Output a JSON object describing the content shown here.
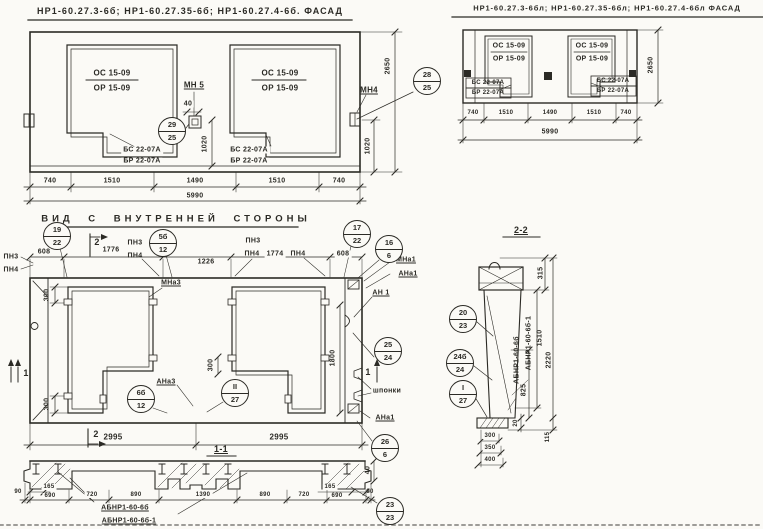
{
  "ink": "#2b2a25",
  "paper": "#fbfaf6",
  "facade_main": {
    "title": "НР1-60.27.3-6б; НР1-60.27.35-6б; НР1-60.27.4-6б. ФАСАД",
    "win1_line1": "ОС 15-09",
    "win1_line2": "ОР 15-09",
    "win2_line1": "ОС 15-09",
    "win2_line2": "ОР 15-09",
    "win1_sill1": "БС 22-07А",
    "win1_sill2": "БР 22-07А",
    "win2_sill1": "БС 22-07А",
    "win2_sill2": "БР 22-07А",
    "label_mn5": "МН 5",
    "label_mn4": "МН4",
    "dim_40": "40",
    "balloon_29_top": "29",
    "balloon_29_bot": "25",
    "balloon_28_top": "28",
    "balloon_28_bot": "25",
    "dim_1020_mid": "1020",
    "dim_1020_right": "1020",
    "dim_2650": "2650",
    "dims_bottom": [
      "740",
      "1510",
      "1490",
      "1510",
      "740"
    ],
    "dim_total": "5990"
  },
  "facade_l": {
    "title": "НР1-60.27.3-6бл; НР1-60.27.35-6бл; НР1-60.27.4-6бл ФАСАД",
    "win1_line1": "ОС 15-09",
    "win1_line2": "ОР 15-09",
    "win2_line1": "ОС 15-09",
    "win2_line2": "ОР 15-09",
    "win1_sill1": "БС 22-07А",
    "win1_sill2": "БР 22-07А",
    "win2_sill1": "БС 22-07А",
    "win2_sill2": "БР 22-07А",
    "dims_bottom": [
      "740",
      "1510",
      "1490",
      "1510",
      "740"
    ],
    "dim_total": "5990",
    "dim_2650": "2650"
  },
  "inner": {
    "title": "ВИД С ВНУТРЕННЕЙ СТОРОНЫ",
    "pn3_far_left": "ПН3",
    "pn4_far_left": "ПН4",
    "dim_608_left": "608",
    "dim_1776": "1776",
    "dim_1226": "1226",
    "dim_1774": "1774",
    "dim_608_right": "608",
    "pn3_a": "ПН3",
    "pn4_a": "ПН4",
    "pn3_b": "ПН3",
    "pn4_b": "ПН4",
    "pn4_c": "ПН4",
    "balloon_19_top": "19",
    "balloon_19_bot": "22",
    "balloon_5b_top": "5б",
    "balloon_5b_bot": "12",
    "balloon_17_top": "17",
    "balloon_17_bot": "22",
    "balloon_16_top": "16",
    "balloon_16_bot": "6",
    "marker2_top": "2",
    "marker2_bottom": "2",
    "marker1_left": "1",
    "marker1_right": "1",
    "label_mna1_top": "МНа1",
    "label_ana1_top": "АНа1",
    "label_mna3": "МНа3",
    "label_ana3": "АНа3",
    "label_an1": "АН 1",
    "label_shponki": "шпонки",
    "label_ana1_right": "АНа1",
    "balloon_25_top": "25",
    "balloon_25_bot": "24",
    "balloon_26_top": "26",
    "balloon_26_bot": "6",
    "balloon_6b_top": "6б",
    "balloon_6b_bot": "12",
    "balloon_ii_top": "II",
    "balloon_ii_bot": "27",
    "dim_300_a": "300",
    "dim_300_b": "300",
    "dim_300_c": "300",
    "dim_1800": "1800",
    "dim_2995_left": "2995",
    "dim_2995_right": "2995"
  },
  "section11": {
    "title": "1-1",
    "dim_90_left": "90",
    "dim_165_left": "165",
    "dim_690_left": "690",
    "dims_main": [
      "720",
      "890",
      "1390",
      "890",
      "720"
    ],
    "dim_165_right": "165",
    "dim_690_right": "690",
    "dim_90_right": "90",
    "dim_40": "40",
    "label_ab1": "АБНР1-60-6б",
    "label_ab2": "АБНР1-60-6б-1",
    "balloon_23_top": "23",
    "balloon_23_bot": "23"
  },
  "section22": {
    "title": "2-2",
    "balloon_20_top": "20",
    "balloon_20_bot": "23",
    "balloon_24b_top": "24б",
    "balloon_24b_bot": "24",
    "balloon_i_top": "I",
    "balloon_i_bot": "27",
    "label_ab1": "АБНР1-60-6б",
    "label_ab2": "АБНР1-60-6б-1",
    "dim_825": "825",
    "dim_1510": "1510",
    "dim_2220": "2220",
    "dim_315": "315",
    "dim_20": "20",
    "dim_115": "115",
    "dim_300": "300",
    "dim_350": "350",
    "dim_400": "400"
  }
}
